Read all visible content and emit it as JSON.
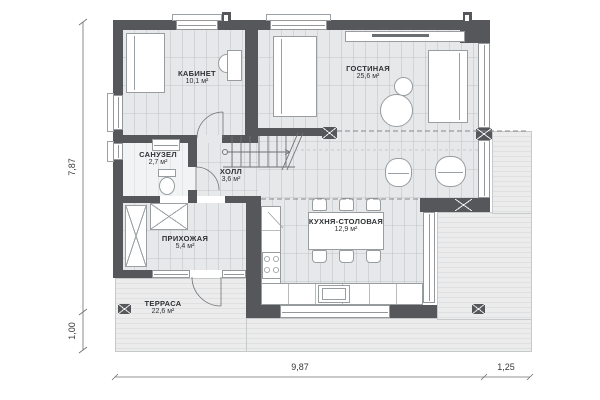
{
  "plan": {
    "type": "architectural-floor-plan",
    "rooms": [
      {
        "name": "КАБИНЕТ",
        "area": "10,1 м²"
      },
      {
        "name": "ГОСТИНАЯ",
        "area": "25,6 м²"
      },
      {
        "name": "САНУЗЕЛ",
        "area": "2,7 м²"
      },
      {
        "name": "ХОЛЛ",
        "area": "3,6 м²"
      },
      {
        "name": "ПРИХОЖАЯ",
        "area": "5,4 м²"
      },
      {
        "name": "КУХНЯ-СТОЛОВАЯ",
        "area": "12,9 м²"
      },
      {
        "name": "ТЕРРАСА",
        "area": "22,6 м²"
      }
    ],
    "dimensions": {
      "left_total": "7,87",
      "left_terrace": "1,00",
      "bottom_total": "9,87",
      "bottom_deck": "1,25"
    },
    "colors": {
      "wall": "#55575a",
      "floor": "#e6e8e9",
      "deck": "#ececed",
      "furniture_outline": "#989da0",
      "dimension_line": "#6d7072"
    }
  }
}
